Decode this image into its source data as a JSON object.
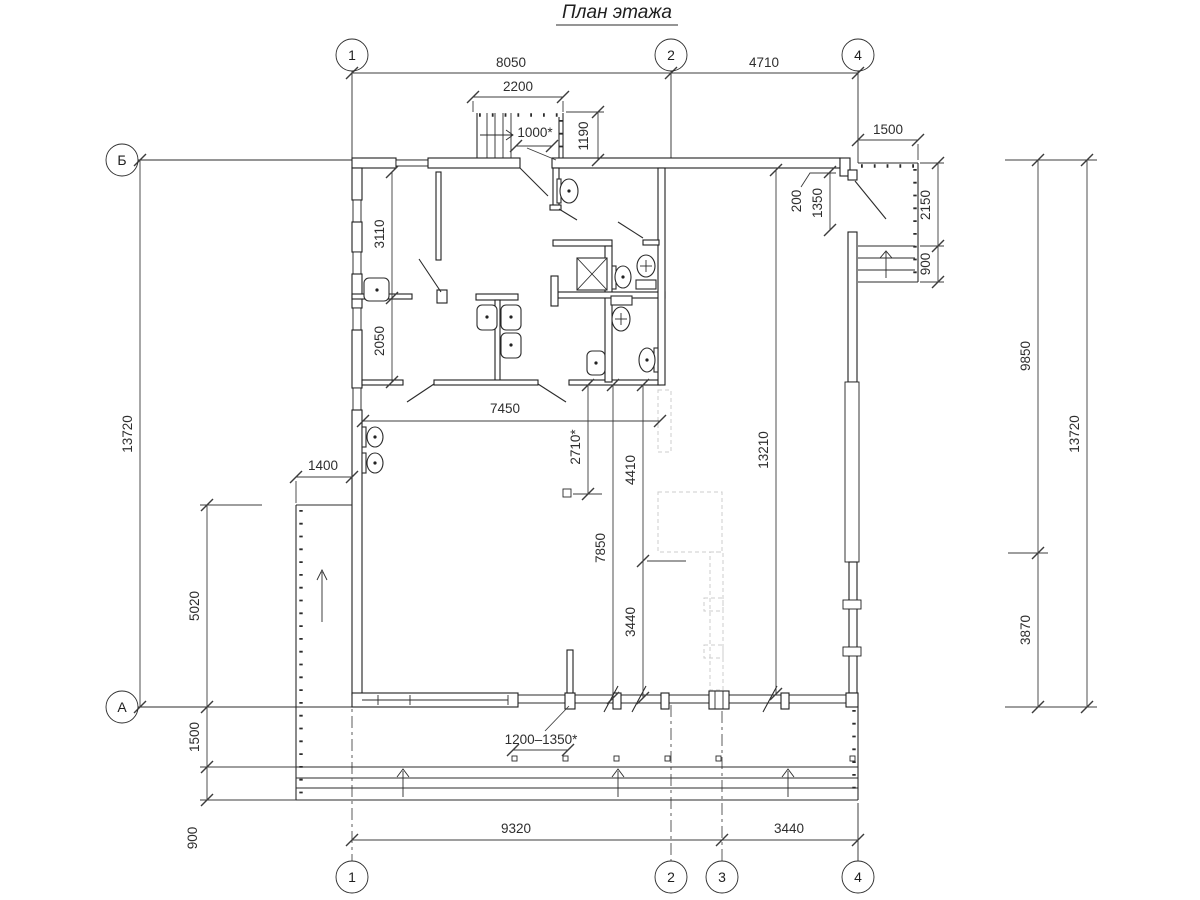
{
  "title": "План этажа",
  "axes": {
    "top": [
      "1",
      "2",
      "4"
    ],
    "bottom": [
      "1",
      "2",
      "3",
      "4"
    ],
    "left": [
      "Б",
      "А"
    ]
  },
  "dimensions": {
    "top": {
      "overall_1_2": "8050",
      "overall_2_4": "4710",
      "stair_width": "2200",
      "entry_door": "1000*",
      "stair_depth": "1190",
      "porch_width": "1500"
    },
    "right": {
      "wall_jog": "200",
      "side_door": "1350",
      "porch_depth": "2150",
      "porch_steps": "900",
      "right_upper": "9850",
      "right_lower": "3870",
      "overall_right": "13720"
    },
    "left": {
      "overall_left": "13720",
      "room_top": "3110",
      "room_mid": "2050",
      "ramp_width": "1400",
      "ramp_length": "5020",
      "terrace_depth": "1500",
      "terrace_steps": "900"
    },
    "interior": {
      "hall_width": "7450",
      "hall_a": "2710*",
      "hall_b": "4410",
      "hall_c": "7850",
      "hall_d": "3440",
      "hall_overall": "13210"
    },
    "bottom": {
      "post_spacing": "1200–1350*",
      "overall_1_3": "9320",
      "overall_3_4": "3440"
    }
  }
}
